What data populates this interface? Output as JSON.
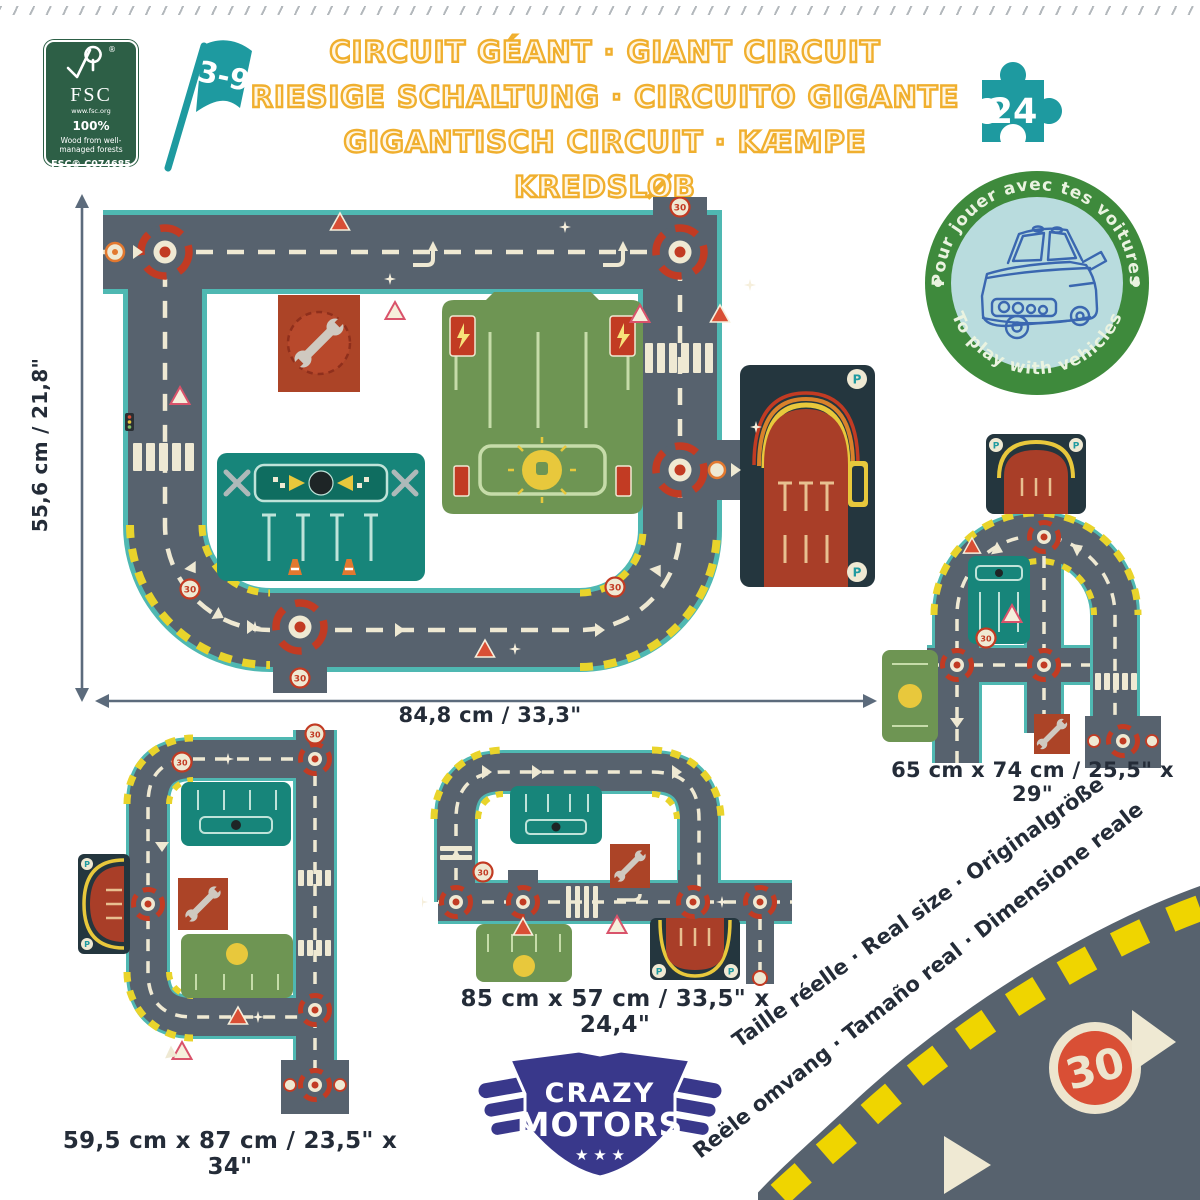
{
  "header": {
    "fsc": {
      "reg": "®",
      "brand": "FSC",
      "url": "www.fsc.org",
      "percent": "100%",
      "desc1": "Wood from well-",
      "desc2": "managed forests",
      "license": "FSC® C074685"
    },
    "age_flag": "3-9",
    "title_lines": [
      "CIRCUIT GÉANT · GIANT CIRCUIT",
      "RIESIGE SCHALTUNG · CIRCUITO GIGANTE",
      "GIGANTISCH CIRCUIT · KÆMPE KREDSLØB"
    ],
    "pieces_count": "24"
  },
  "play_badge": {
    "arc_top": "Pour jouer avec tes voitures",
    "arc_bottom": "To play with vehicles"
  },
  "dimensions": {
    "main_height": "55,6 cm / 21,8\"",
    "main_width": "84,8 cm / 33,3\"",
    "layout_right": "65 cm x 74 cm / 25,5\" x 29\"",
    "layout_bottom_left": "59,5 cm x 87 cm / 23,5\" x 34\"",
    "layout_bottom_middle": "85 cm x 57 cm / 33,5\" x 24,4\""
  },
  "real_size_note": {
    "line1": "Taille réelle · Real size · Originalgröße",
    "line2": "Reële omvang · Tamaño real · Dimensione reale"
  },
  "signs": {
    "speed_30": "30",
    "parking": "P"
  },
  "brand_logo": {
    "line1": "CRAZY",
    "line2": "MOTORS",
    "stars": "★ ★ ★"
  },
  "colors": {
    "title_gold": "#F0AF2E",
    "teal": "#1E9AA0",
    "fsc_green": "#2D5F46",
    "badge_ring": "#3E8A3C",
    "badge_fill": "#B9DCDE",
    "car_line": "#3A67B0",
    "road": "#57626E",
    "road_edge": "#4FB8B2",
    "road_marking": "#EFE9D3",
    "hazard_yellow": "#EFD500",
    "signal_red": "#C23B23",
    "building_green": "#6E9553",
    "building_teal": "#17857A",
    "garage_red": "#A93E28",
    "garage_navy": "#24363E",
    "logo_blue": "#39388B"
  }
}
